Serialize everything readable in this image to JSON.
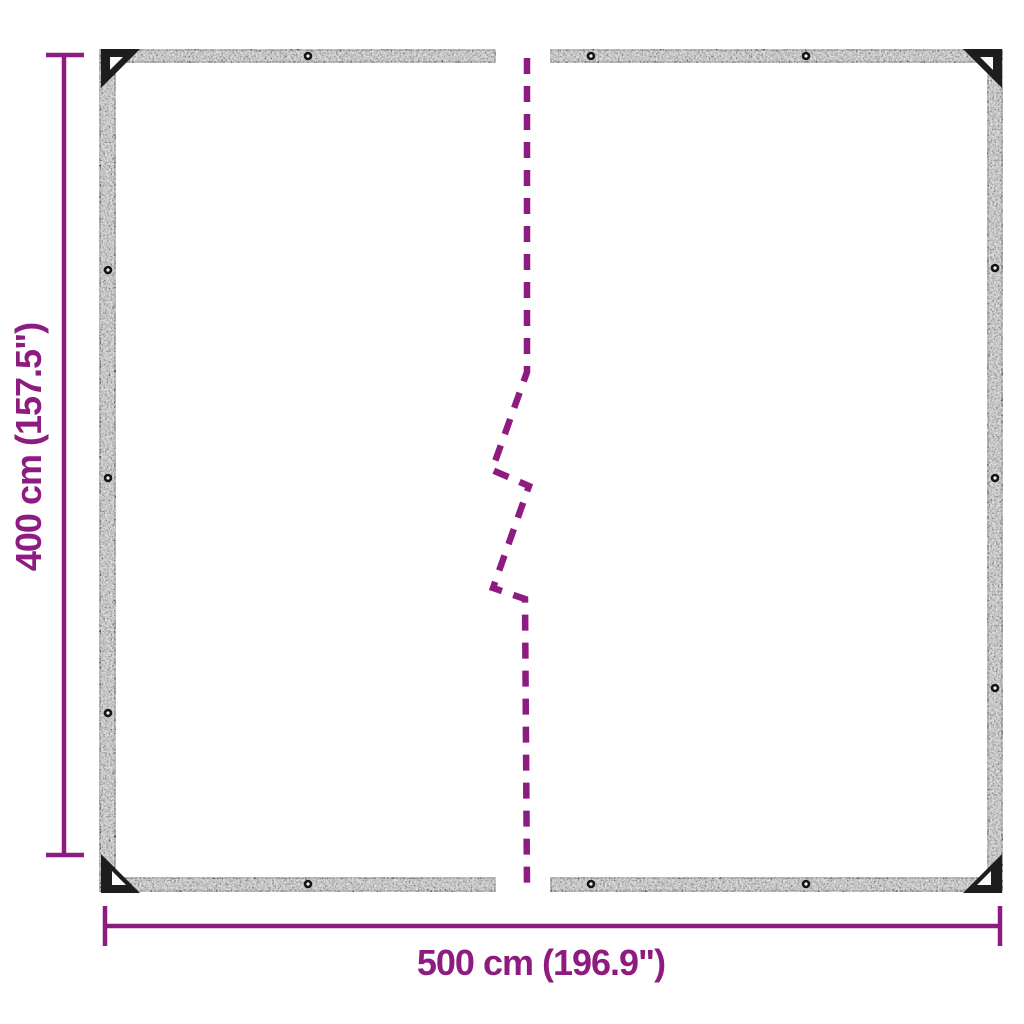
{
  "diagram": {
    "type": "product-dimension-diagram",
    "subject": "clear tarpaulin with eyelets, middle section broken out"
  },
  "labels": {
    "height": "400 cm (157.5\")",
    "width": "500 cm (196.9\")"
  },
  "colors": {
    "accent": "#8E1B7F",
    "tarp_band_gray": "#9B9B9B",
    "tarp_edge_dark": "#1B1B1B",
    "background": "#FFFFFF"
  },
  "tarp": {
    "grommets": [
      [
        308,
        56
      ],
      [
        591,
        56
      ],
      [
        806,
        56
      ],
      [
        308,
        884
      ],
      [
        591,
        884
      ],
      [
        806,
        884
      ],
      [
        108,
        270
      ],
      [
        108,
        478
      ],
      [
        108,
        713
      ],
      [
        995,
        268
      ],
      [
        995,
        478
      ],
      [
        995,
        688
      ]
    ],
    "corner_reinforcements": 4
  }
}
